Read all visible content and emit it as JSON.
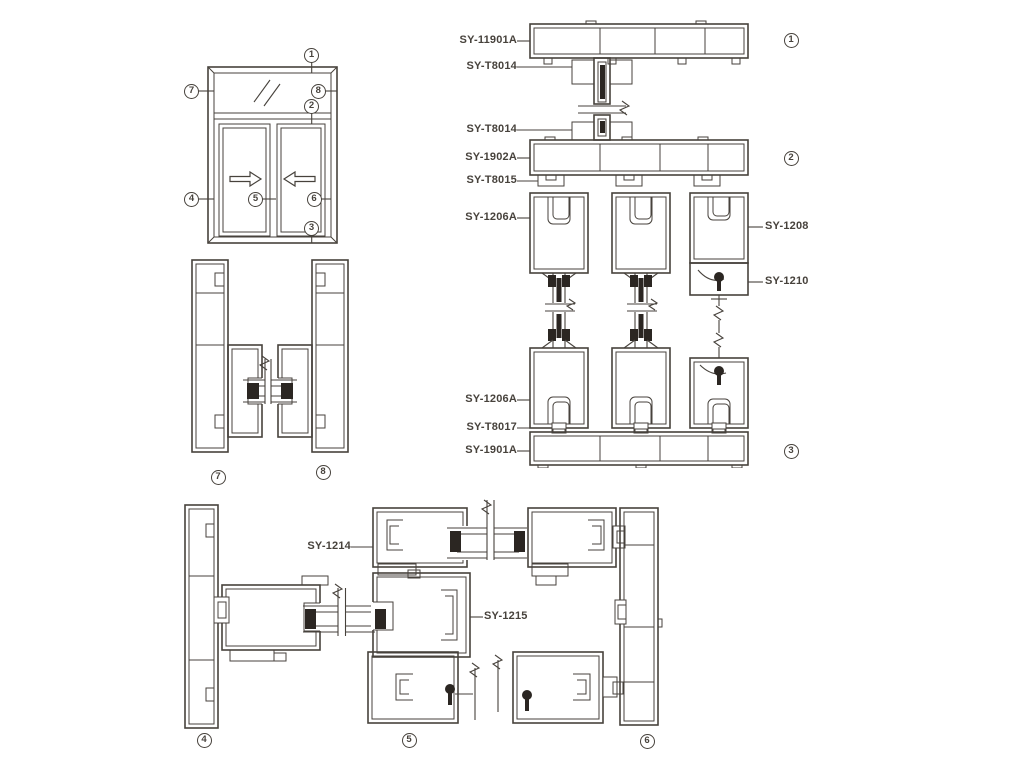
{
  "colors": {
    "line": "#47423c",
    "dark": "#2b2622",
    "background": "#ffffff"
  },
  "elevation": {
    "callouts": [
      "1",
      "7",
      "8",
      "2",
      "4",
      "5",
      "6",
      "3"
    ]
  },
  "section_78": {
    "callouts": [
      "7",
      "8"
    ]
  },
  "vertical_stack": {
    "left_labels": [
      "SY-11901A",
      "SY-T8014",
      "SY-T8014",
      "SY-1902A",
      "SY-T8015",
      "SY-1206A",
      "SY-1206A",
      "SY-T8017",
      "SY-1901A"
    ],
    "right_labels": [
      "SY-1208",
      "SY-1210"
    ],
    "callouts": [
      "1",
      "2",
      "3"
    ]
  },
  "horizontal_stack": {
    "labels": [
      "SY-1214",
      "SY-1215"
    ],
    "callouts": [
      "4",
      "5",
      "6"
    ]
  }
}
